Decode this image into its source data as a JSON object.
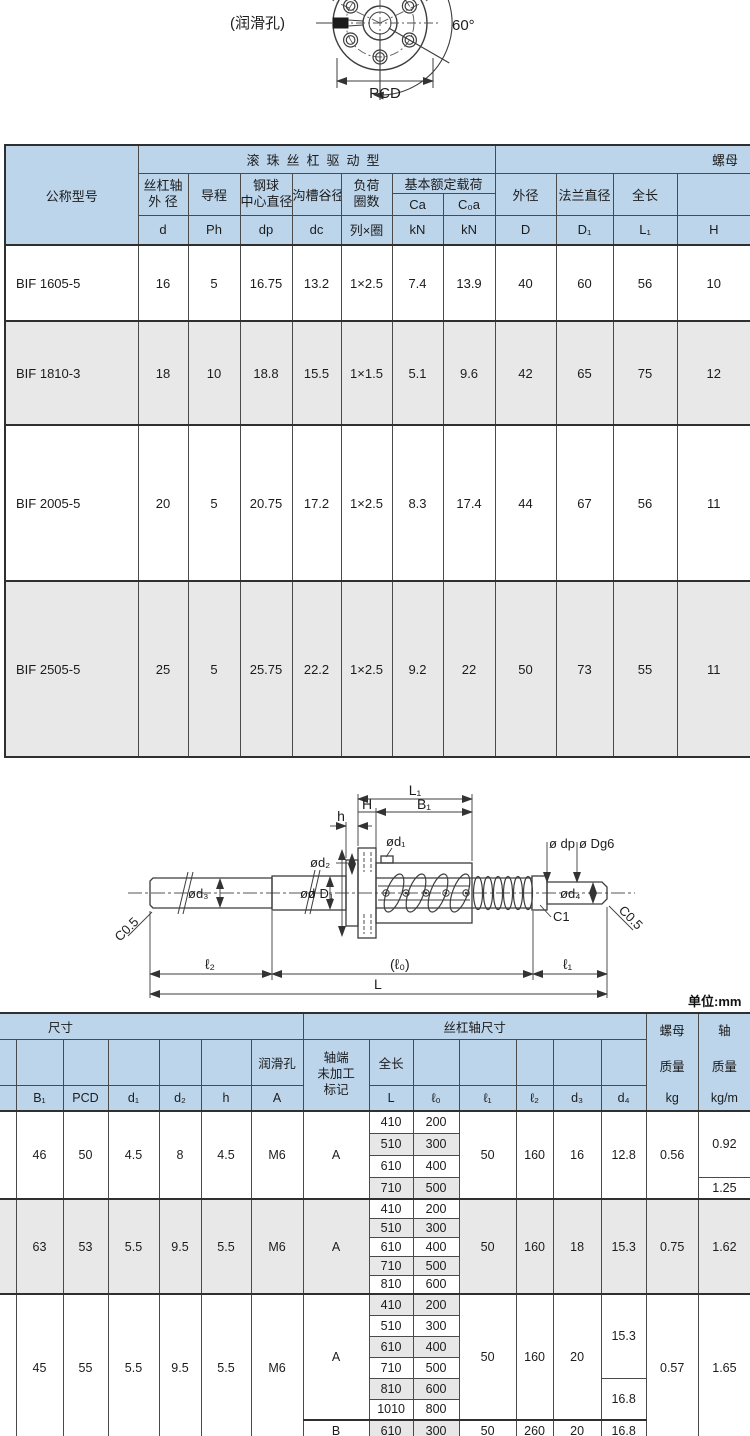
{
  "page": {
    "unit_note": "单位:mm"
  },
  "front_view": {
    "lube_label": "(润滑孔)",
    "pcd_label": "PCD",
    "angle_label": "60°"
  },
  "side_view": {
    "dim_l1_total": "L₁",
    "dim_b1": "B₁",
    "dim_H": "H",
    "dim_h": "h",
    "dim_d1": "ød₁",
    "dim_d2": "ød₂",
    "dim_dp": "ø dp",
    "dim_dg6": "ø Dg6",
    "dim_d3": "ød₃",
    "dim_d": "ød",
    "dim_D1": "ø D₁",
    "dim_d4": "ød₄",
    "dim_c1": "C1",
    "dim_c05_left": "C0.5",
    "dim_c05_right": "C0.5",
    "dim_l2": "ℓ₂",
    "dim_l0": "(ℓ₀)",
    "dim_el1": "ℓ₁",
    "dim_L": "L"
  },
  "spec_table": {
    "title_model": "公称型号",
    "group_drive": "滚珠丝杠驱动型",
    "group_nut": "螺母",
    "group_load": "基本额定载荷",
    "col_shaft_od_1": "丝杠轴",
    "col_shaft_od_2": "外 径",
    "col_lead": "导程",
    "col_ball_1": "钢球",
    "col_ball_2": "中心直径",
    "col_root": "沟槽谷径",
    "col_circuits_1": "负荷",
    "col_circuits_2": "圈数",
    "col_od": "外径",
    "col_flange": "法兰直径",
    "col_len": "全长",
    "sym": {
      "d": "d",
      "ph": "Ph",
      "dp": "dp",
      "dc": "dc",
      "rows_turns": "列×圈",
      "ca": "Ca",
      "c0a": "C₀a",
      "kn1": "kN",
      "kn2": "kN",
      "D": "D",
      "D1": "D₁",
      "L1": "L₁",
      "H": "H"
    },
    "rows": [
      {
        "model": "BIF 1605-5",
        "v": [
          "16",
          "5",
          "16.75",
          "13.2",
          "1×2.5",
          "7.4",
          "13.9",
          "40",
          "60",
          "56",
          "10"
        ]
      },
      {
        "model": "BIF 1810-3",
        "v": [
          "18",
          "10",
          "18.8",
          "15.5",
          "1×1.5",
          "5.1",
          "9.6",
          "42",
          "65",
          "75",
          "12"
        ]
      },
      {
        "model": "BIF 2005-5",
        "v": [
          "20",
          "5",
          "20.75",
          "17.2",
          "1×2.5",
          "8.3",
          "17.4",
          "44",
          "67",
          "56",
          "11"
        ]
      },
      {
        "model": "BIF 2505-5",
        "v": [
          "25",
          "5",
          "25.75",
          "22.2",
          "1×2.5",
          "9.2",
          "22",
          "50",
          "73",
          "55",
          "11"
        ]
      }
    ]
  },
  "dim_table": {
    "group_dims": "尺寸",
    "group_shaft": "丝杠轴尺寸",
    "nut_mass_1": "螺母",
    "nut_mass_2": "质量",
    "nut_mass_unit": "kg",
    "shaft_mass_1": "轴",
    "shaft_mass_2": "质量",
    "shaft_mass_unit": "kg/m",
    "lube_header": "润滑孔",
    "mark_header_1": "轴端",
    "mark_header_2": "未加工",
    "mark_header_3": "标记",
    "len_header": "全长",
    "sym": {
      "b1": "B₁",
      "pcd": "PCD",
      "d1": "d₁",
      "d2": "d₂",
      "h": "h",
      "a": "A",
      "L": "L",
      "l0": "ℓ₀",
      "l1": "ℓ₁",
      "l2": "ℓ₂",
      "d3": "d₃",
      "d4": "d₄"
    },
    "groups": [
      {
        "b1": "46",
        "pcd": "50",
        "d1": "4.5",
        "d2": "8",
        "h": "4.5",
        "a": "M6",
        "mark": "A",
        "pairs": [
          [
            "410",
            "200"
          ],
          [
            "510",
            "300"
          ],
          [
            "610",
            "400"
          ],
          [
            "710",
            "500"
          ]
        ],
        "l1": "50",
        "l2": "160",
        "d3": "16",
        "d4": "12.8",
        "kg": "0.56",
        "kgm_a": "0.92",
        "kgm_b": "1.25"
      },
      {
        "b1": "63",
        "pcd": "53",
        "d1": "5.5",
        "d2": "9.5",
        "h": "5.5",
        "a": "M6",
        "mark": "A",
        "pairs": [
          [
            "410",
            "200"
          ],
          [
            "510",
            "300"
          ],
          [
            "610",
            "400"
          ],
          [
            "710",
            "500"
          ],
          [
            "810",
            "600"
          ]
        ],
        "l1": "50",
        "l2": "160",
        "d3": "18",
        "d4": "15.3",
        "kg": "0.75",
        "kgm": "1.62"
      },
      {
        "b1": "45",
        "pcd": "55",
        "d1": "5.5",
        "d2": "9.5",
        "h": "5.5",
        "a": "M6",
        "mark_a": "A",
        "mark_b": "B",
        "pairs_a": [
          [
            "410",
            "200"
          ],
          [
            "510",
            "300"
          ],
          [
            "610",
            "400"
          ],
          [
            "710",
            "500"
          ],
          [
            "810",
            "600"
          ],
          [
            "1010",
            "800"
          ]
        ],
        "pair_b": [
          "610",
          "300"
        ],
        "l1_a": "50",
        "l2_a": "160",
        "d3_a": "20",
        "d4_a1": "15.3",
        "d4_a2": "16.8",
        "l1_b": "50",
        "l2_b": "260",
        "d3_b": "20",
        "d4_b": "16.8",
        "kg": "0.57",
        "kgm": "1.65"
      }
    ]
  }
}
